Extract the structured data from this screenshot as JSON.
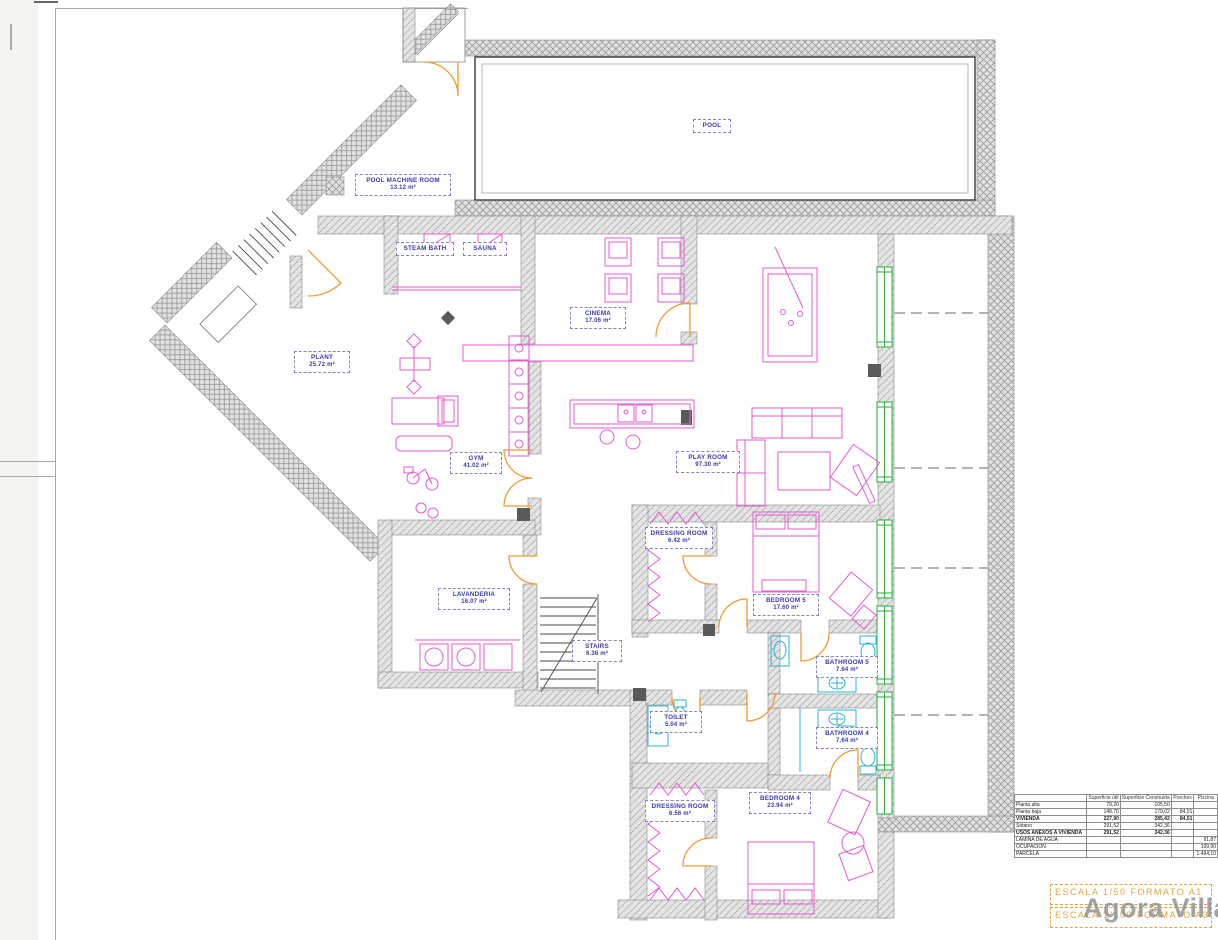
{
  "rooms": [
    {
      "id": "pool",
      "name": "POOL",
      "area": ""
    },
    {
      "id": "pool-machine-room",
      "name": "POOL MACHINE ROOM",
      "area": "13.12 m²"
    },
    {
      "id": "steam-bath",
      "name": "STEAM BATH",
      "area": ""
    },
    {
      "id": "sauna",
      "name": "SAUNA",
      "area": ""
    },
    {
      "id": "cinema",
      "name": "CINEMA",
      "area": "17.06 m²"
    },
    {
      "id": "plant",
      "name": "PLANT",
      "area": "25.72 m²"
    },
    {
      "id": "gym",
      "name": "GYM",
      "area": "41.02 m²"
    },
    {
      "id": "play-room",
      "name": "PLAY ROOM",
      "area": "97.30 m²"
    },
    {
      "id": "lavanderia",
      "name": "LAVANDERIA",
      "area": "16.07 m²"
    },
    {
      "id": "stairs",
      "name": "STAIRS",
      "area": "6.36 m²"
    },
    {
      "id": "dressing-room-5",
      "name": "DRESSING ROOM",
      "area": "6.42 m²"
    },
    {
      "id": "bedroom-5",
      "name": "BEDROOM 5",
      "area": "17.60 m²"
    },
    {
      "id": "bathroom-5",
      "name": "BATHROOM 5",
      "area": "7.64 m²"
    },
    {
      "id": "toilet",
      "name": "TOILET",
      "area": "5.04 m²"
    },
    {
      "id": "bathroom-4",
      "name": "BATHROOM 4",
      "area": "7.64 m²"
    },
    {
      "id": "dressing-room-4",
      "name": "DRESSING ROOM",
      "area": "6.56 m²"
    },
    {
      "id": "bedroom-4",
      "name": "BEDROOM 4",
      "area": "23.94 m²"
    }
  ],
  "areas_table": {
    "headers": [
      "",
      "Superficie útil",
      "Superficie Construida",
      "Porches",
      "Piscina"
    ],
    "rows": [
      {
        "name": "Planta alta",
        "util": "79,20",
        "construida": "105,50",
        "porches": "",
        "piscina": ""
      },
      {
        "name": "Planta baja",
        "util": "148,70",
        "construida": "179,02",
        "porches": "84,51",
        "piscina": ""
      },
      {
        "name": "VIVIENDA",
        "util": "227,90",
        "construida": "285,42",
        "porches": "84,51",
        "piscina": ""
      },
      {
        "name": "Sótano",
        "util": "291,52",
        "construida": "342,36",
        "porches": "",
        "piscina": ""
      },
      {
        "name": "USOS ANEXOS A VIVIENDA",
        "util": "291,52",
        "construida": "342,36",
        "porches": "",
        "piscina": ""
      },
      {
        "name": "LAMINA DE AGUA",
        "util": "",
        "construida": "",
        "porches": "",
        "piscina": "91,87"
      },
      {
        "name": "OCUPACION",
        "util": "",
        "construida": "",
        "porches": "",
        "piscina": "199,90"
      },
      {
        "name": "PARCELA",
        "util": "",
        "construida": "",
        "porches": "",
        "piscina": "1.494,10"
      }
    ]
  },
  "title_block": {
    "scale_line_1": "ESCALA 1/50 FORMATO A1",
    "scale_line_2": "ESCALA 1/100 FORMATO A3"
  },
  "watermark": {
    "text": "Agora Villas"
  },
  "colors": {
    "wall_gray": "#9a9a9a",
    "furniture_magenta": "#e65ad5",
    "sanitary_cyan": "#28b4d8",
    "door_orange": "#f29a2e",
    "window_green": "#35b446",
    "label_blue": "#3a3aad",
    "scale_orange": "#e8a23c"
  }
}
